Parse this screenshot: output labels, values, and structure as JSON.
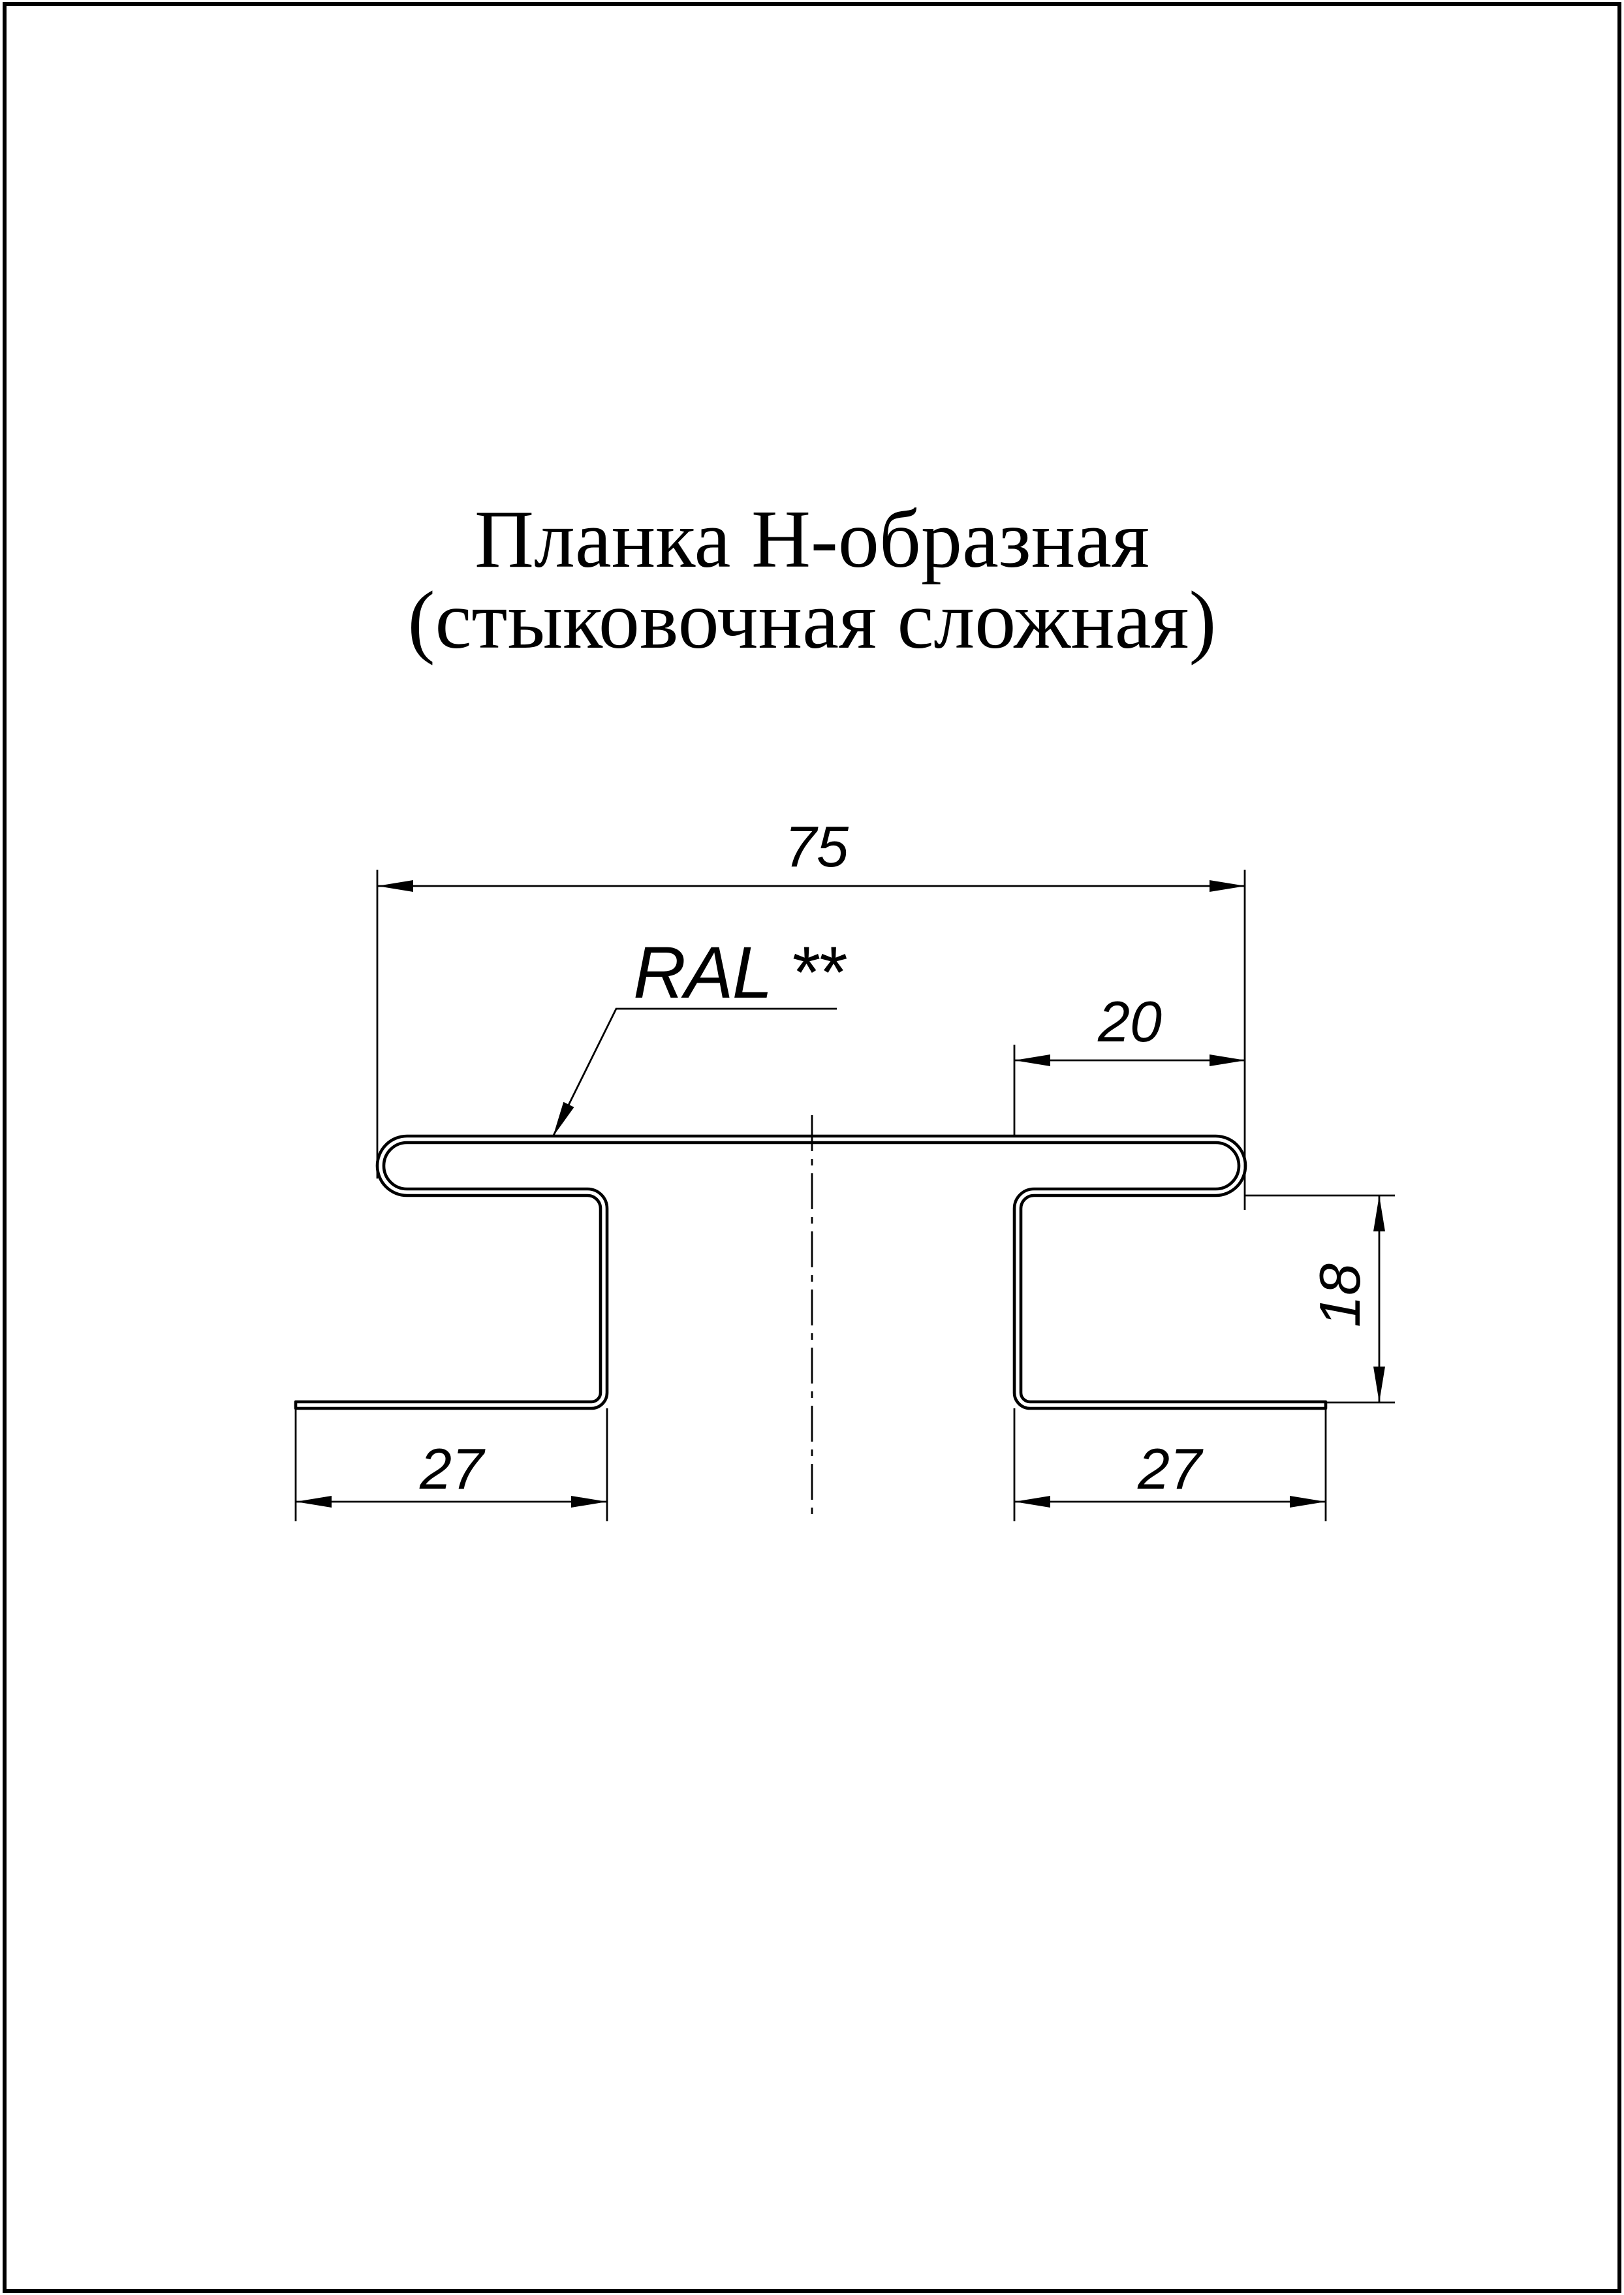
{
  "page": {
    "background": "#ffffff",
    "line_color": "#000000"
  },
  "title": {
    "line1": "Планка Н-образная",
    "line2": "(стыковочная сложная)"
  },
  "coating_label": "RAL **",
  "dims": {
    "top_width": "75",
    "right_overhang": "20",
    "leg_height": "18",
    "left_foot_width": "27",
    "right_foot_width": "27"
  }
}
